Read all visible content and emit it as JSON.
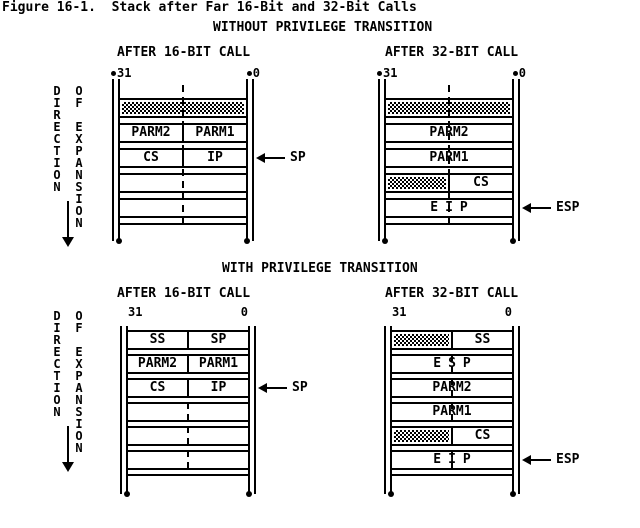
{
  "title": "Figure 16-1.  Stack after Far 16-Bit and 32-Bit Calls",
  "direction": {
    "word1": "DIRECTION",
    "word2": "OF EXPANSION"
  },
  "colors": {
    "foreground": "#000000",
    "background": "#ffffff"
  },
  "sections": [
    {
      "heading": "WITHOUT PRIVILEGE TRANSITION",
      "columns": [
        {
          "heading": "AFTER 16-BIT CALL",
          "stack": {
            "bit_high": "31",
            "bit_low": "0",
            "corner_bullets": true,
            "rows": [
              {
                "cells": [
                  {
                    "type": "hatch"
                  }
                ]
              },
              {
                "cells": [
                  {
                    "type": "text",
                    "text": "PARM2"
                  },
                  {
                    "type": "text",
                    "text": "PARM1"
                  }
                ]
              },
              {
                "cells": [
                  {
                    "type": "text",
                    "text": "CS"
                  },
                  {
                    "type": "text",
                    "text": "IP"
                  }
                ]
              },
              {
                "cells": [
                  {
                    "type": "empty"
                  }
                ]
              },
              {
                "cells": [
                  {
                    "type": "empty"
                  }
                ]
              }
            ],
            "pointer": {
              "label": "SP",
              "row": 2
            }
          }
        },
        {
          "heading": "AFTER 32-BIT CALL",
          "stack": {
            "bit_high": "31",
            "bit_low": "0",
            "corner_bullets": true,
            "rows": [
              {
                "cells": [
                  {
                    "type": "hatch"
                  }
                ]
              },
              {
                "cells": [
                  {
                    "type": "text",
                    "text": "PARM2"
                  }
                ]
              },
              {
                "cells": [
                  {
                    "type": "text",
                    "text": "PARM1"
                  }
                ]
              },
              {
                "cells": [
                  {
                    "type": "hatch"
                  },
                  {
                    "type": "text",
                    "text": "CS"
                  }
                ]
              },
              {
                "cells": [
                  {
                    "type": "text",
                    "text": "EIP",
                    "spaced": true
                  }
                ]
              }
            ],
            "pointer": {
              "label": "ESP",
              "row": 4
            }
          }
        }
      ]
    },
    {
      "heading": "WITH PRIVILEGE TRANSITION",
      "columns": [
        {
          "heading": "AFTER 16-BIT CALL",
          "stack": {
            "bit_high": "31",
            "bit_low": "0",
            "corner_bullets": false,
            "rows": [
              {
                "cells": [
                  {
                    "type": "text",
                    "text": "SS"
                  },
                  {
                    "type": "text",
                    "text": "SP"
                  }
                ]
              },
              {
                "cells": [
                  {
                    "type": "text",
                    "text": "PARM2"
                  },
                  {
                    "type": "text",
                    "text": "PARM1"
                  }
                ]
              },
              {
                "cells": [
                  {
                    "type": "text",
                    "text": "CS"
                  },
                  {
                    "type": "text",
                    "text": "IP"
                  }
                ]
              },
              {
                "cells": [
                  {
                    "type": "empty"
                  }
                ]
              },
              {
                "cells": [
                  {
                    "type": "empty"
                  }
                ]
              },
              {
                "cells": [
                  {
                    "type": "empty"
                  }
                ]
              }
            ],
            "pointer": {
              "label": "SP",
              "row": 2
            }
          }
        },
        {
          "heading": "AFTER 32-BIT CALL",
          "stack": {
            "bit_high": "31",
            "bit_low": "0",
            "corner_bullets": false,
            "rows": [
              {
                "cells": [
                  {
                    "type": "hatch"
                  },
                  {
                    "type": "text",
                    "text": "SS"
                  }
                ]
              },
              {
                "cells": [
                  {
                    "type": "text",
                    "text": "ESP",
                    "spaced": true
                  }
                ]
              },
              {
                "cells": [
                  {
                    "type": "text",
                    "text": "PARM2"
                  }
                ]
              },
              {
                "cells": [
                  {
                    "type": "text",
                    "text": "PARM1"
                  }
                ]
              },
              {
                "cells": [
                  {
                    "type": "hatch"
                  },
                  {
                    "type": "text",
                    "text": "CS"
                  }
                ]
              },
              {
                "cells": [
                  {
                    "type": "text",
                    "text": "EIP",
                    "spaced": true
                  }
                ]
              }
            ],
            "pointer": {
              "label": "ESP",
              "row": 5
            }
          }
        }
      ]
    }
  ]
}
